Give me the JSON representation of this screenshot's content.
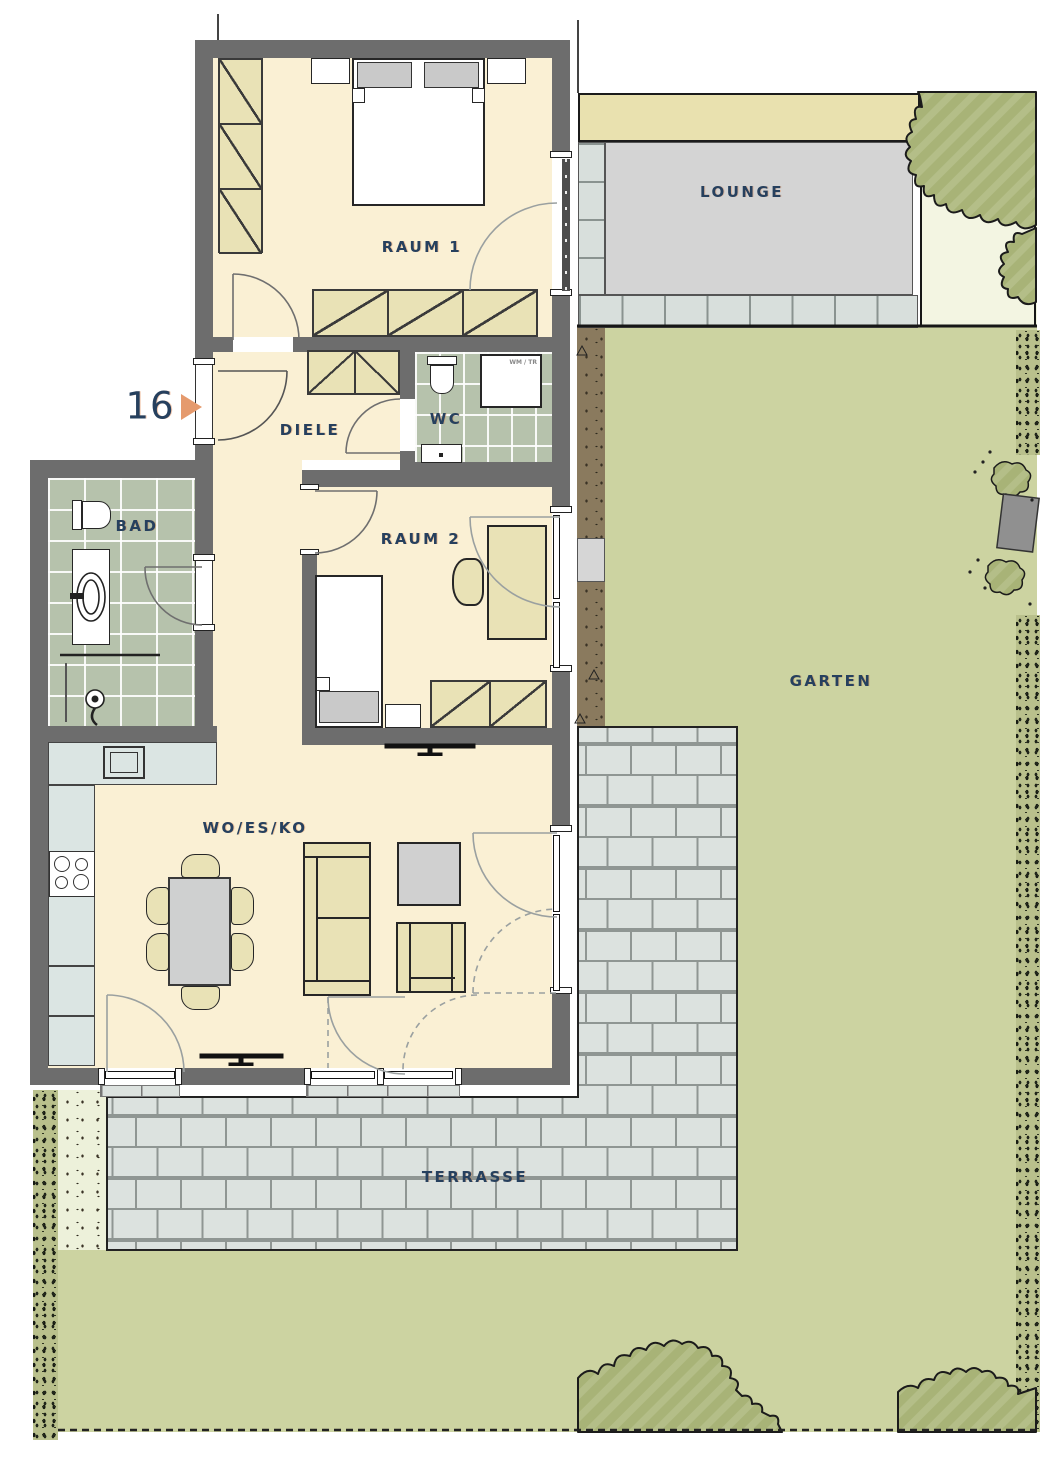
{
  "floorplan": {
    "unit": {
      "number": "16"
    },
    "rooms": {
      "raum1": {
        "label": "RAUM 1"
      },
      "diele": {
        "label": "DIELE"
      },
      "wc": {
        "label": "WC"
      },
      "bad": {
        "label": "BAD"
      },
      "raum2": {
        "label": "RAUM 2"
      },
      "wohnen": {
        "label": "WO/ES/KO"
      }
    },
    "outdoor": {
      "lounge": {
        "label": "LOUNGE"
      },
      "garten": {
        "label": "GARTEN"
      },
      "terrasse": {
        "label": "TERRASSE"
      }
    },
    "appliances": {
      "washer_dryer": "WM / TR"
    },
    "colors": {
      "wall": "#6d6d6d",
      "floor": "#faf0d4",
      "furniture_beige": "#e9e2b6",
      "tile_green": "#b6c2ac",
      "counter_blue": "#dbe5e3",
      "paver": "#dce2df",
      "garden": "#ccd3a1",
      "tree": "#a8b377",
      "lounge_gray": "#d4d4d4",
      "label_navy": "#26405e",
      "arrow_orange": "#e59a6d",
      "soil_brown": "#8a7a5e"
    }
  }
}
